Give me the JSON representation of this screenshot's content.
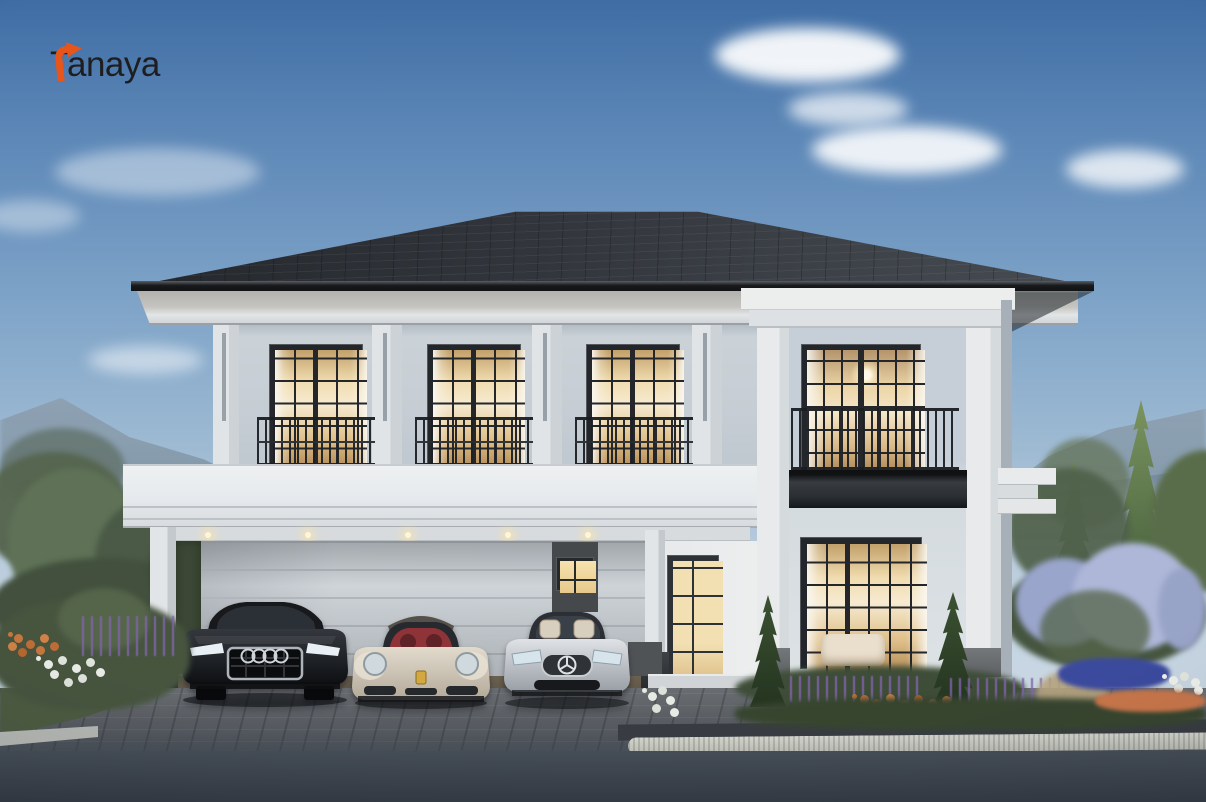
{
  "brand": {
    "logo_text": "Tanaya",
    "logo_mark": "turn-right-arrow-icon",
    "logo_text_color": "#1e1e20",
    "logo_accent_color": "#e8551a"
  },
  "scene": {
    "type": "3d-architectural-exterior-rendering",
    "subject": "Two-storey modern classical detached house at dusk with carport, landscaped garden and three parked cars",
    "time_of_day": "dusk",
    "palette": {
      "sky_top": "#3f6da4",
      "sky_horizon": "#cfdce6",
      "cloud": "#ffffff",
      "mountain_haze": "#8399ab",
      "roof": "#2b2f35",
      "wall_light": "#e9ebec",
      "wall_shade": "#c8d1da",
      "window_frame": "#25282c",
      "window_glow": "#f3e0b0",
      "railing": "#1d2024",
      "foliage": "#4c5c44",
      "lilac": "#aeb7d8",
      "flower_blue": "#3c4a9e",
      "flower_orange": "#c9764a",
      "flower_purple": "#7b63a6",
      "driveway": "#565c63",
      "road": "#3a424d",
      "curb": "#c6c8c0"
    },
    "house": {
      "storeys": 2,
      "roof_type": "hip",
      "upper_floor": {
        "windows": 3,
        "juliet_balconies": 3,
        "tower_balcony_windows": 1,
        "pilasters": 4
      },
      "ground_floor": {
        "carport_bays": 3,
        "ceiling_downlights": 5,
        "front_doors": 1,
        "door_side_windows": 1,
        "living_room_windows": 1,
        "entry_steps": 4
      }
    },
    "cars": [
      {
        "position": "left",
        "type": "suv",
        "brand_mark": "four-rings",
        "body_color": "#23262b"
      },
      {
        "position": "center",
        "type": "sports-coupe",
        "brand_mark": "gold-crest",
        "body_color": "#d2cabd",
        "interior_color": "#8e3338"
      },
      {
        "position": "right",
        "type": "convertible",
        "brand_mark": "three-pointed-star",
        "body_color": "#c6cad0",
        "interior_color": "#d9cfbe"
      }
    ],
    "landscape": {
      "left": [
        "hazy mountains",
        "olive tree",
        "hedge",
        "orange flowers",
        "white flowers",
        "purple flowers"
      ],
      "right": [
        "hazy mountains",
        "spruce tree",
        "round tree",
        "lilac bushes",
        "blue flowers",
        "white flowers",
        "orange flowers",
        "dry grasses"
      ],
      "front": [
        "two conifers",
        "lavender bed",
        "boxwood hedge",
        "paver driveway",
        "granite curb",
        "asphalt road"
      ]
    }
  }
}
